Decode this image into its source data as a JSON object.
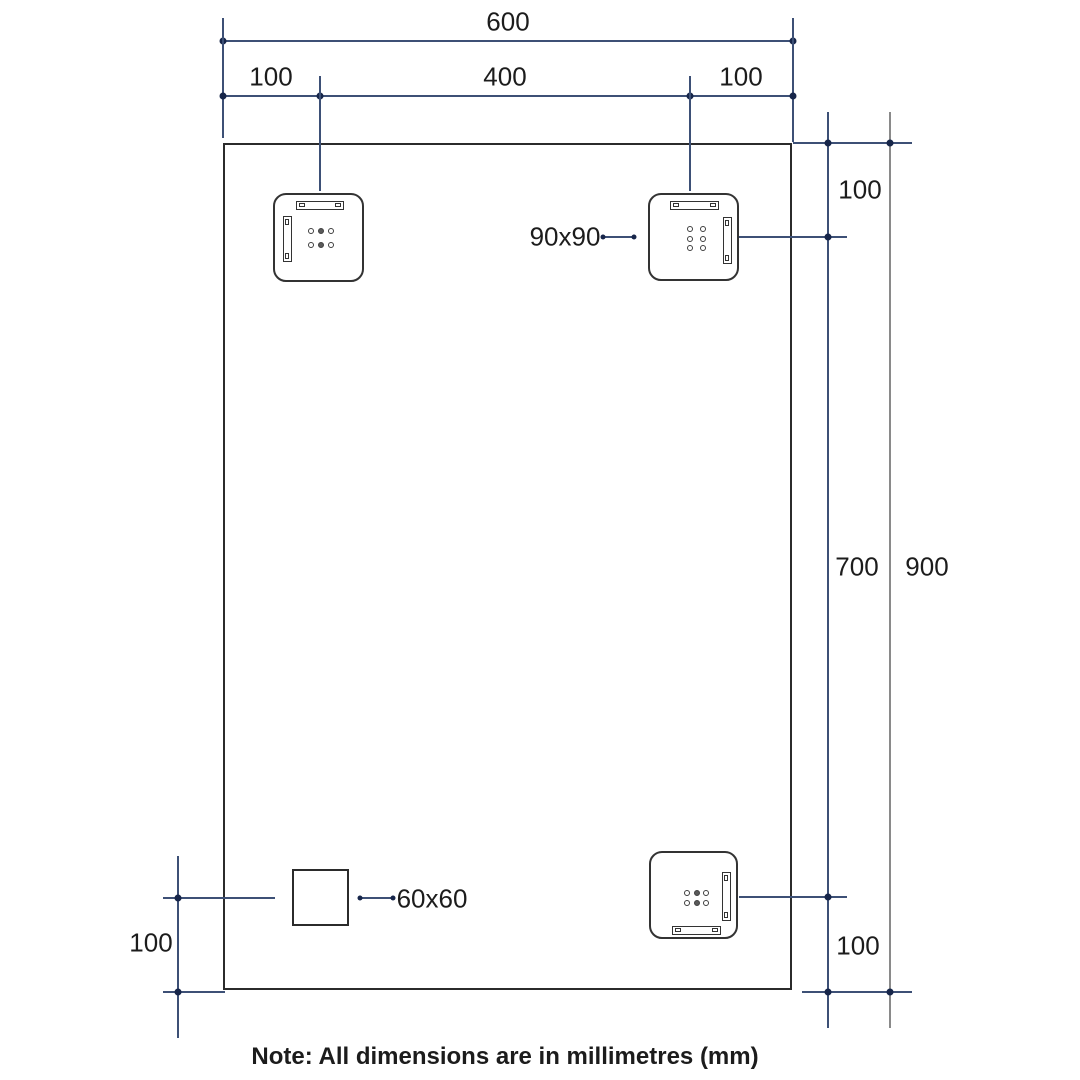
{
  "labels": {
    "overall_width": "600",
    "top_left_offset": "100",
    "top_center_span": "400",
    "top_right_offset": "100",
    "right_top_offset": "100",
    "right_mid_span": "700",
    "overall_height": "900",
    "right_bottom_offset": "100",
    "bottom_left_offset": "100",
    "bracket_size": "90x90",
    "square_size": "60x60",
    "note": "Note: All dimensions are in millimetres (mm)"
  },
  "drawing": {
    "type": "technical-dimension-drawing",
    "units": "mm",
    "panel": {
      "width_mm": 600,
      "height_mm": 900
    },
    "fixtures": {
      "mounting_brackets": {
        "size_mm": "90x90",
        "count": 3,
        "positions": [
          "top-left",
          "top-right",
          "bottom-right"
        ]
      },
      "square_block": {
        "size_mm": "60x60",
        "count": 1,
        "position": "bottom-left"
      }
    },
    "offsets_mm": {
      "top_edge_to_bracket_center": 100,
      "side_edge_to_bracket_center": 100,
      "bracket_center_spacing_horizontal": 400,
      "bracket_center_span_vertical": 700,
      "bottom_edge_to_fixture_center": 100
    }
  },
  "colors": {
    "dimension_line": "#3d5076",
    "dimension_dot": "#17264a",
    "overall_height_line": "#8a8a8a",
    "outline": "#2b2b2b",
    "text": "#1c1c1c",
    "background": "#ffffff"
  }
}
